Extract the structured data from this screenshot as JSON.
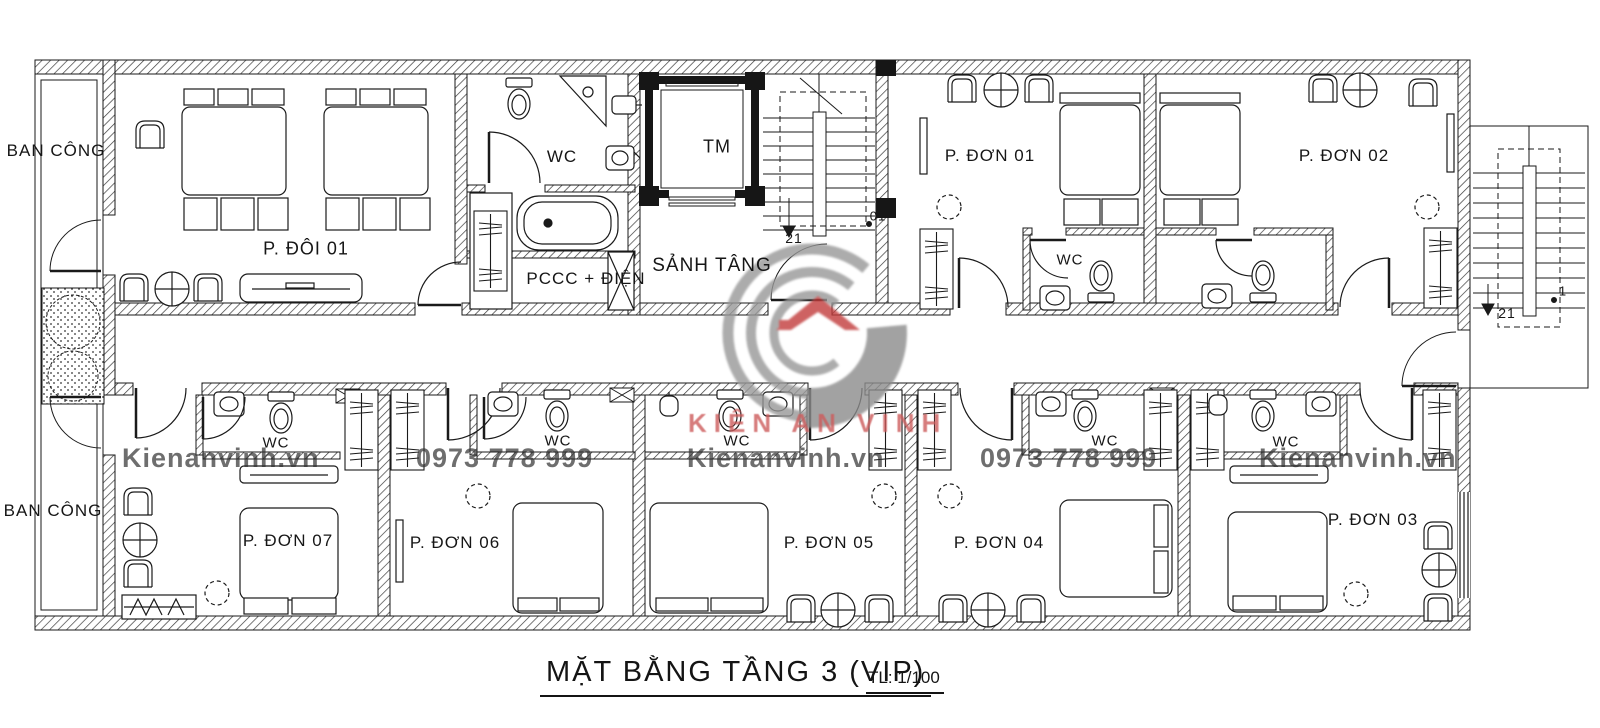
{
  "title": {
    "text": "MẶT BẰNG TẦNG 3 (VIP)",
    "scale": "TL: 1/100"
  },
  "labels": {
    "balcony": "BAN CÔNG",
    "double_room": "P. ĐÔI 01",
    "wc": "WC",
    "elevator": "TM",
    "utility": "PCCC + ĐIỆN",
    "lobby": "SẢNH TÂNG",
    "rooms": [
      "P. ĐƠN 01",
      "P. ĐƠN 02",
      "P. ĐƠN 03",
      "P. ĐƠN 04",
      "P. ĐƠN 05",
      "P. ĐƠN 06",
      "P. ĐƠN 07"
    ],
    "stair_inner": {
      "top": "21",
      "start": "01"
    },
    "stair_outer": {
      "top": "21",
      "start": "1"
    }
  },
  "watermark": {
    "site": "Kienanvinh.vn",
    "phone": "0973 778 999",
    "brand": "KIÊN AN VINH"
  },
  "colors": {
    "ink": "#1a1a1a",
    "watermark_gray": "#2f2f2f",
    "brand_red": "#cd5c5c",
    "logo_gray": "#989898",
    "logo_dark": "#8c8c8c",
    "roof_red": "#c23b3b"
  }
}
